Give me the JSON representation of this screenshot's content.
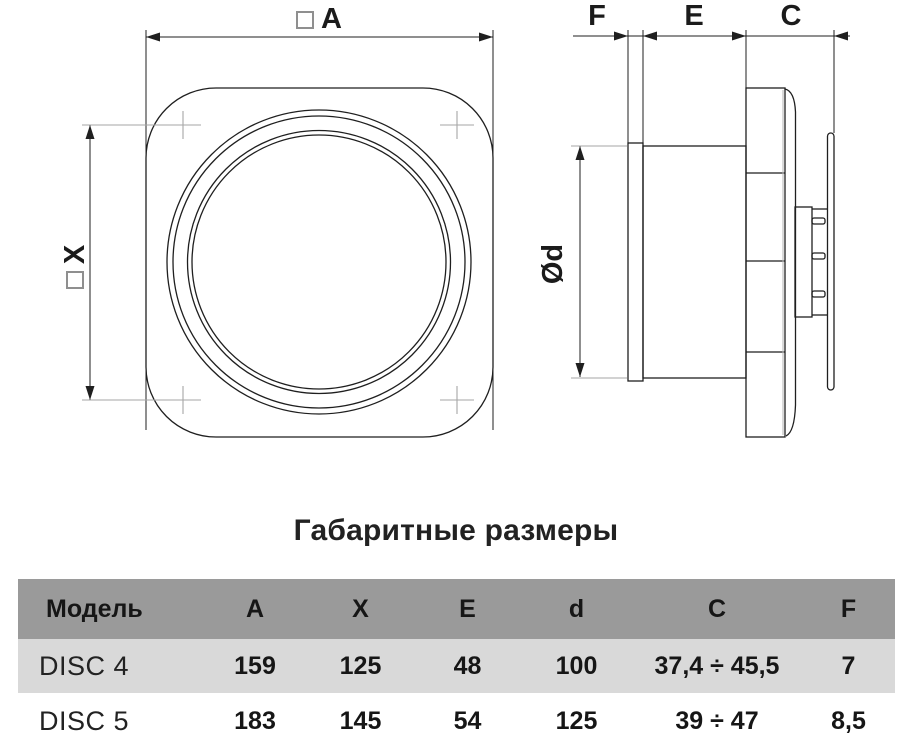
{
  "title": "Габаритные размеры",
  "drawing": {
    "front_view": {
      "dim_a_label": "A",
      "dim_x_label": "X"
    },
    "side_view": {
      "dim_f_label": "F",
      "dim_e_label": "E",
      "dim_c_label": "C",
      "dim_d_label": "Ød"
    }
  },
  "table": {
    "headers": [
      "Модель",
      "A",
      "X",
      "E",
      "d",
      "C",
      "F"
    ],
    "rows": [
      {
        "model": "DISC 4",
        "values": [
          "159",
          "125",
          "48",
          "100",
          "37,4 ÷ 45,5",
          "7"
        ]
      },
      {
        "model": "DISC 5",
        "values": [
          "183",
          "145",
          "54",
          "125",
          "39 ÷ 47",
          "8,5"
        ]
      }
    ]
  },
  "colors": {
    "table_header_bg": "#9a9a9a",
    "table_row_alt_bg": "#d9d9d9",
    "line_color": "#1f1f1f",
    "aux_line_color": "#a6a6a6"
  }
}
